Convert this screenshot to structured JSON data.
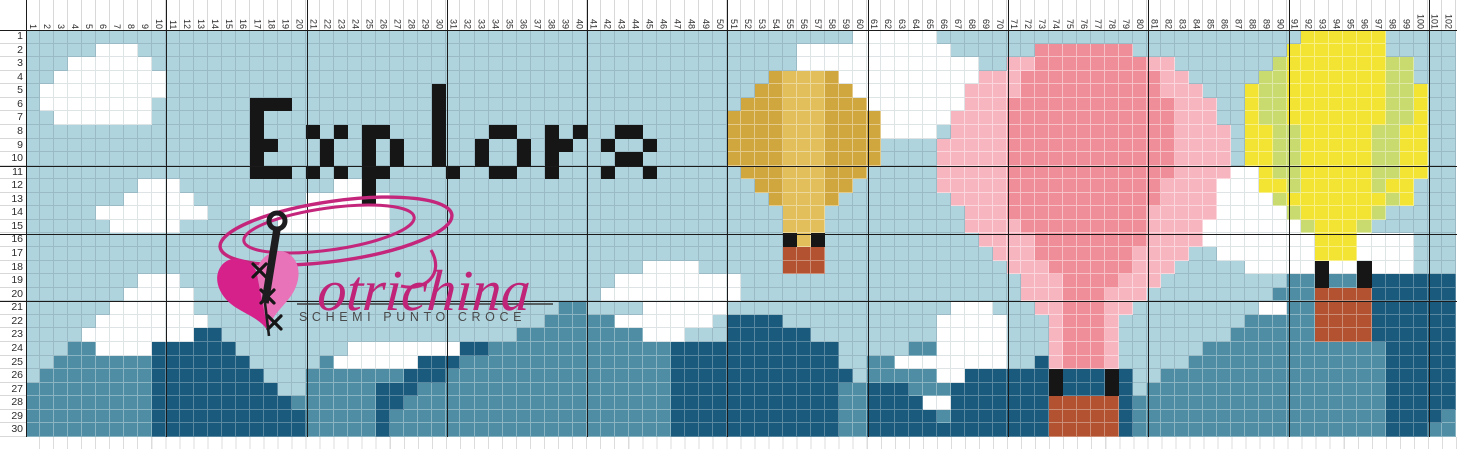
{
  "chart": {
    "type": "cross-stitch-pattern",
    "cols": 102,
    "rows": 30,
    "pixel_text": {
      "value": "Explore",
      "color": "#161616"
    },
    "col_labels": [
      "1",
      "2",
      "3",
      "4",
      "5",
      "6",
      "7",
      "8",
      "9",
      "10",
      "11",
      "12",
      "13",
      "14",
      "15",
      "16",
      "17",
      "18",
      "19",
      "20",
      "21",
      "22",
      "23",
      "24",
      "25",
      "26",
      "27",
      "28",
      "29",
      "30",
      "31",
      "32",
      "33",
      "34",
      "35",
      "36",
      "37",
      "38",
      "39",
      "40",
      "41",
      "42",
      "43",
      "44",
      "45",
      "46",
      "47",
      "48",
      "49",
      "50",
      "51",
      "52",
      "53",
      "54",
      "55",
      "56",
      "57",
      "58",
      "59",
      "60",
      "61",
      "62",
      "63",
      "64",
      "65",
      "66",
      "67",
      "68",
      "69",
      "70",
      "71",
      "72",
      "73",
      "74",
      "75",
      "76",
      "77",
      "78",
      "79",
      "80",
      "81",
      "82",
      "83",
      "84",
      "85",
      "86",
      "87",
      "88",
      "89",
      "90",
      "91",
      "92",
      "93",
      "94",
      "95",
      "96",
      "97",
      "98",
      "99",
      "100",
      "101",
      "102"
    ],
    "row_labels": [
      "1",
      "2",
      "3",
      "4",
      "5",
      "6",
      "7",
      "8",
      "9",
      "10",
      "11",
      "12",
      "13",
      "14",
      "15",
      "16",
      "17",
      "18",
      "19",
      "20",
      "21",
      "22",
      "23",
      "24",
      "25",
      "26",
      "27",
      "28",
      "29",
      "30"
    ],
    "palette": {
      "S": "#afd4de",
      "W": "#ffffff",
      "K": "#161616",
      "G": "#d0a73f",
      "H": "#e2bf5b",
      "P": "#ef8e99",
      "L": "#f7b5bf",
      "Y": "#f3e434",
      "V": "#c9db6e",
      "M": "#4e8da4",
      "D": "#1a5a7c",
      "R": "#b25231"
    },
    "palette_legend": {
      "S": "sky-blue",
      "W": "cloud-white",
      "K": "black",
      "G": "gold-dark",
      "H": "gold-light",
      "P": "rose-dark",
      "L": "rose-light",
      "Y": "yellow",
      "V": "yellow-green",
      "M": "teal-mid",
      "D": "teal-dark",
      "R": "rust-basket"
    },
    "rows_rle": [
      "59S 6W 26S 6Y 5S",
      "5S 3W 47S 11W 6S 7P 11S 7Y 5S",
      "3S 6W 46S 13W 2S 2L 8P 2L 7S 1V 7Y 2V 3S",
      "2S 8W 43S 1G 3H 1G 10W 3L 10P 2L 5S 2V 7Y 2V 3S",
      "1S 9W 19S 1K 22S 2G 3H 2G 8W 4L 10P 3L 3S 1Y 2V 7Y 2V 1Y 2S",
      "1S 8W 7S 3K 10S 1K 21S 3G 3H 3G 7W 3L 12P 3L 2S 1Y 2V 7Y 2V 1Y 2S",
      "2S 7W 7S 1K 12S 1K 20S 4G 3H 4G 5W 4L 12P 3L 2S 1Y 2V 7Y 2V 1Y 2S",
      "16S 1K 3S 1K 1S 1K 1S 2K 3S 1K 3S 2K 2S 1K 1S 1K 2S 2K 6S 4G 3H 4G 4W 1S 4L 12P 4L 1S 2Y 2V 5Y 2V 2Y 2S",
      "16S 2K 3S 1K 2S 1K 1S 1K 2S 1K 2S 1K 2S 1K 1S 2K 2S 1K 2S 1K 5S 4G 3H 4G 4S 5L 12P 4L 1S 2Y 2V 5Y 2V 2Y 2S",
      "16S 1K 4S 1K 2S 1K 1S 1K 2S 1K 2S 1K 2S 1K 1S 1K 4S 2K 6S 4G 3H 4G 4S 5L 12P 4L 1S 2Y 2V 5Y 2V 2Y 2S",
      "16S 3K 1S 1K 1S 1K 1S 2K 4S 1K 2S 2K 2S 1K 3S 1K 2S 1K 6S 3G 3H 3G 5S 5L 12P 4L 2W 1Y 2V 5Y 2V 2Y 2S",
      "8S 3W 11S 2W 1K 27S 2G 3H 2G 6S 5L 11P 4L 3W 2Y 1V 5Y 1V 2Y 3S",
      "7S 5W 8S 4W 1K 1W 27S 1G 3H 1G 8S 4L 11P 4L 4W 1V 7Y 1V 1Y 3S",
      "5S 8W 3S 10W 28S 3H 10S 3L 10P 5L 5W 1V 5Y 1V 5S",
      "6S 5W 7S 8W 28S 3H 10S 4L 9P 4L 7W 1V 3Y 1V 6S",
      "54S 1K 1H 1K 11S 4L 8P 4L 8W 3Y 4W 3S",
      "54S 3R 12S 3L 7P 4L 2S 7W 3Y 4W 3S",
      "44S 4W 6S 3R 13S 3L 6P 3L 5S 5W 1K 2W 1K 3W 3S",
      "8S 3W 31S 9W 20S 3L 4P 3L 9S 2M 1K 2M 1K 6D",
      "7S 5W 29S 10W 20S 3L 3P 3L 9S 3M 4R 6D",
      "6S 6W 26S 2M 4S 6W 16S 3W 3S 2L 3P 2L 9S 2W 2M 4R 6D",
      "5S 8W 24S 5M 7W 1S 4D 11S 5W 3S 1L 3P 1L 9S 5M 4R 6D",
      "4S 8W 2D 21S 9M 3W 3S 6D 9S 5W 3S 1L 3P 1L 8S 6M 4R 6D",
      "3S 2M 4W 6D 8S 8W 2D 13M 12D 5S 2M 5W 3S 1L 3P 1L 6S 13M 5D",
      "2S 7M 7D 5S 1M 6W 3D 15M 12D 2S 2M 8W 2S 1D 1L 3P 1L 5S 14M 5D",
      "1S 8M 8D 3S 7M 3D 16M 13D 1S 5M 2W 6D 1K 3D 1K 1D 2S 16M 5D",
      "9M 9D 2S 5M 3D 18M 12D 2M 3D 3M 7D 1K 3D 1K 1D 1S 17M 5D",
      "9M 10D 6M 2D 19M 12D 2M 4D 2W 7D 5R 1D 18M 5D",
      "9M 11D 5M 1D 20M 12D 2M 5D 1M 7D 5R 1D 18M 4D 1M",
      "9M 11D 5M 1D 20M 12D 2M 13D 5R 1D 18M 3D 2M"
    ]
  },
  "logo": {
    "script_text": "otrichina",
    "tagline": "SCHEMI  PUNTO  CROCE",
    "script_color": "#bf2478",
    "swirl_color": "#c4267c",
    "tagline_color": "#4a4a4a",
    "heart_left_color": "#d6218b",
    "heart_right_color": "#e873b8",
    "needle_color": "#1d1d1f"
  }
}
